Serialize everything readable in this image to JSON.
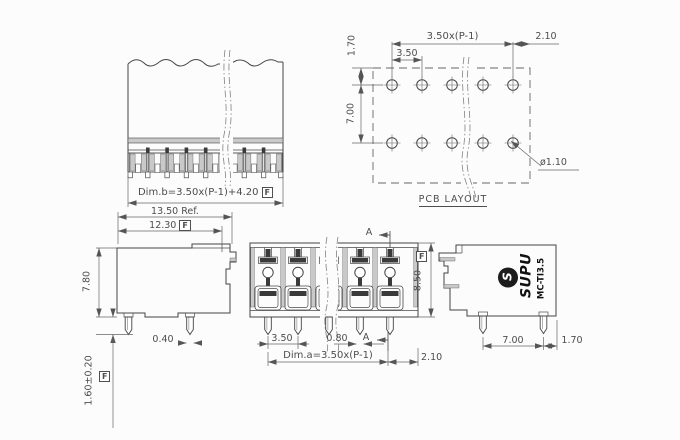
{
  "colors": {
    "outline": "#454545",
    "dimension": "#5a5a5a",
    "text": "#4d4d4d",
    "gray_fill": "#c9c9c9",
    "dark_fill": "#3a3a3a",
    "logo_fill": "#1c1c1c"
  },
  "flag": "F",
  "views": {
    "front_top": {
      "dim_b": "Dim.b=3.50x(P-1)+4.20"
    },
    "pcb": {
      "title": "PCB LAYOUT",
      "dim_total": "3.50x(P-1)",
      "dim_end": "2.10",
      "dim_pitch": "3.50",
      "dim_row_offset": "1.70",
      "dim_row_pitch": "7.00",
      "dim_hole_dia": "ø1.10"
    },
    "side_left": {
      "dim_depth_ref": "13.50 Ref.",
      "dim_depth": "12.30",
      "dim_height": "7.80",
      "dim_pin_w": "0.40",
      "dim_pin_len": "1.60±0.20"
    },
    "front_detail": {
      "section": "A",
      "dim_height": "8.50",
      "dim_pitch": "3.50",
      "dim_pin_w": "0.80",
      "dim_a": "Dim.a=3.50x(P-1)",
      "dim_end": "2.10"
    },
    "side_right": {
      "brand": "SUPU",
      "model": "MC-TI3.5",
      "logo_glyph": "S",
      "dim_pin_span": "7.00",
      "dim_end": "1.70"
    }
  }
}
